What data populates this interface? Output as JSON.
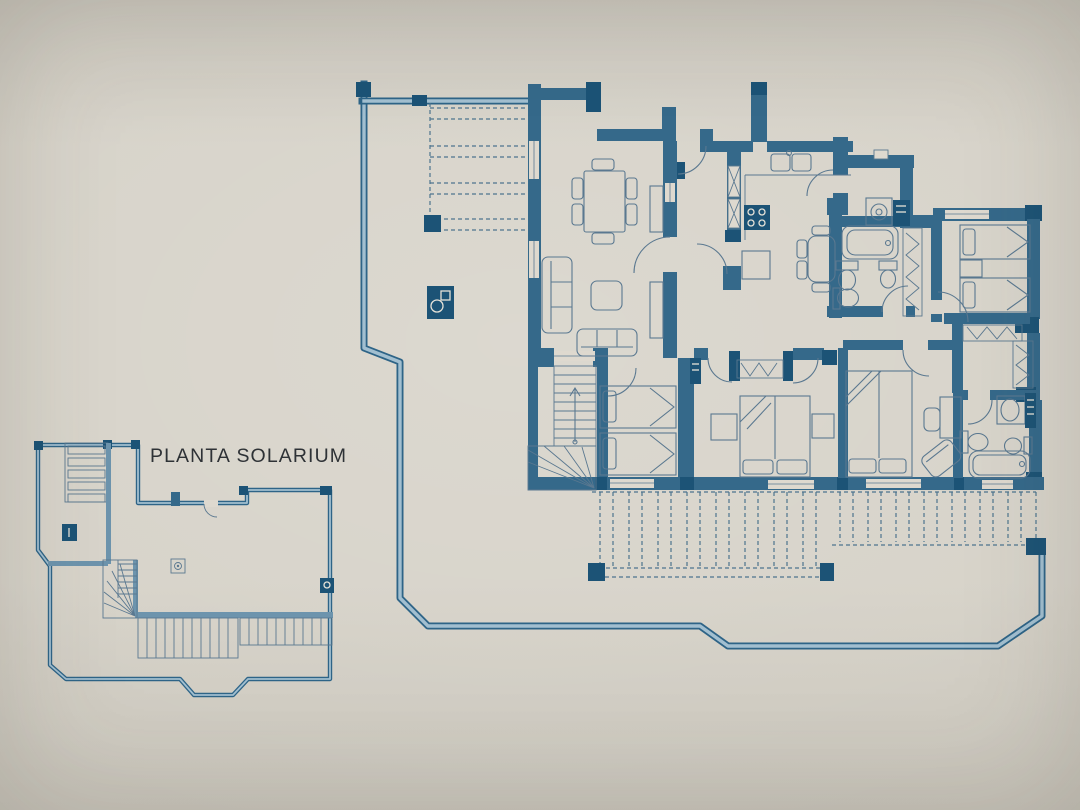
{
  "plan": {
    "title": "PLANTA SOLARIUM",
    "colors": {
      "paper": "#d6d2c8",
      "paper_shade": "#c9c5bb",
      "wall": "#35698a",
      "wall_dark": "#1c5376",
      "edge_dark": "#2e6487",
      "edge_light": "#a2bfd0",
      "small_wall": "#6d94ad",
      "furniture_line": "#5a7890",
      "pergola_dash": "#4d748e",
      "window_fill": "#ded9cf",
      "ink": "#2e3236"
    },
    "main_plan": {
      "rooms": [
        "terrace",
        "living-dining-room",
        "entry",
        "kitchen",
        "utility-room",
        "bathroom-1",
        "hallway",
        "bedroom-1",
        "dressing-area",
        "bathroom-2",
        "bedroom-2",
        "bedroom-3",
        "bedroom-4",
        "stair-hall",
        "south-terrace"
      ],
      "fixtures": [
        "dining-table",
        "dining-chairs",
        "sofa",
        "loveseat",
        "coffee-table",
        "sideboard",
        "kitchen-sink",
        "stove",
        "fridge",
        "appliance-column",
        "breakfast-table",
        "washing-machine",
        "dryer",
        "bathtub",
        "toilet",
        "bidet",
        "washbasin",
        "wardrobe",
        "single-beds",
        "double-beds",
        "nightstands",
        "desk",
        "desk-chair",
        "armchair",
        "stairs",
        "pergola-joists",
        "barbecue"
      ]
    },
    "solarium_plan": {
      "rooms": [
        "roof-terrace",
        "stairwell"
      ],
      "fixtures": [
        "roof-slats",
        "chimney",
        "skylight-table",
        "drain",
        "stairs",
        "pergola-slats"
      ]
    }
  }
}
